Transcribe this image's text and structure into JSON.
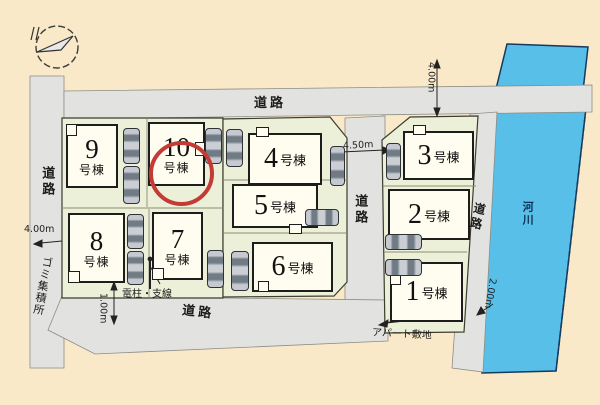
{
  "plan": {
    "buildings": [
      {
        "label": "1号棟",
        "number": "1",
        "suffix": "号棟",
        "highlighted": false
      },
      {
        "label": "2号棟",
        "number": "2",
        "suffix": "号棟",
        "highlighted": false
      },
      {
        "label": "3号棟",
        "number": "3",
        "suffix": "号棟",
        "highlighted": false
      },
      {
        "label": "4号棟",
        "number": "4",
        "suffix": "号棟",
        "highlighted": false
      },
      {
        "label": "5号棟",
        "number": "5",
        "suffix": "号棟",
        "highlighted": false
      },
      {
        "label": "6号棟",
        "number": "6",
        "suffix": "号棟",
        "highlighted": false
      },
      {
        "label": "7号棟",
        "number": "7",
        "suffix": "号棟",
        "highlighted": false
      },
      {
        "label": "8号棟",
        "number": "8",
        "suffix": "号棟",
        "highlighted": false
      },
      {
        "label": "9号棟",
        "number": "9",
        "suffix": "号棟",
        "highlighted": false
      },
      {
        "label": "10号棟",
        "number": "10",
        "suffix": "号棟",
        "highlighted": true
      }
    ],
    "roads": {
      "top": "道路",
      "left": "道路",
      "center": "道路",
      "bottom": "道路",
      "riverside": "道路"
    },
    "river_label": "河川",
    "annotations": {
      "garbage_station": "ゴミ集積所",
      "utility_pole": "電柱・支線",
      "apartment_site": "アパート敷地"
    },
    "measurements": {
      "left_road": "4.00m",
      "center_road": "4.50m",
      "top_right_road": "4.00m",
      "riverside_path": "2.00m",
      "pole_offset": "1.00m"
    },
    "colors": {
      "background": "#f9e9c8",
      "road": "#e2e2e1",
      "block": "#edf0d9",
      "building": "#fffdf0",
      "river": "#58bfe9",
      "highlight_ring": "#c43a35"
    }
  }
}
